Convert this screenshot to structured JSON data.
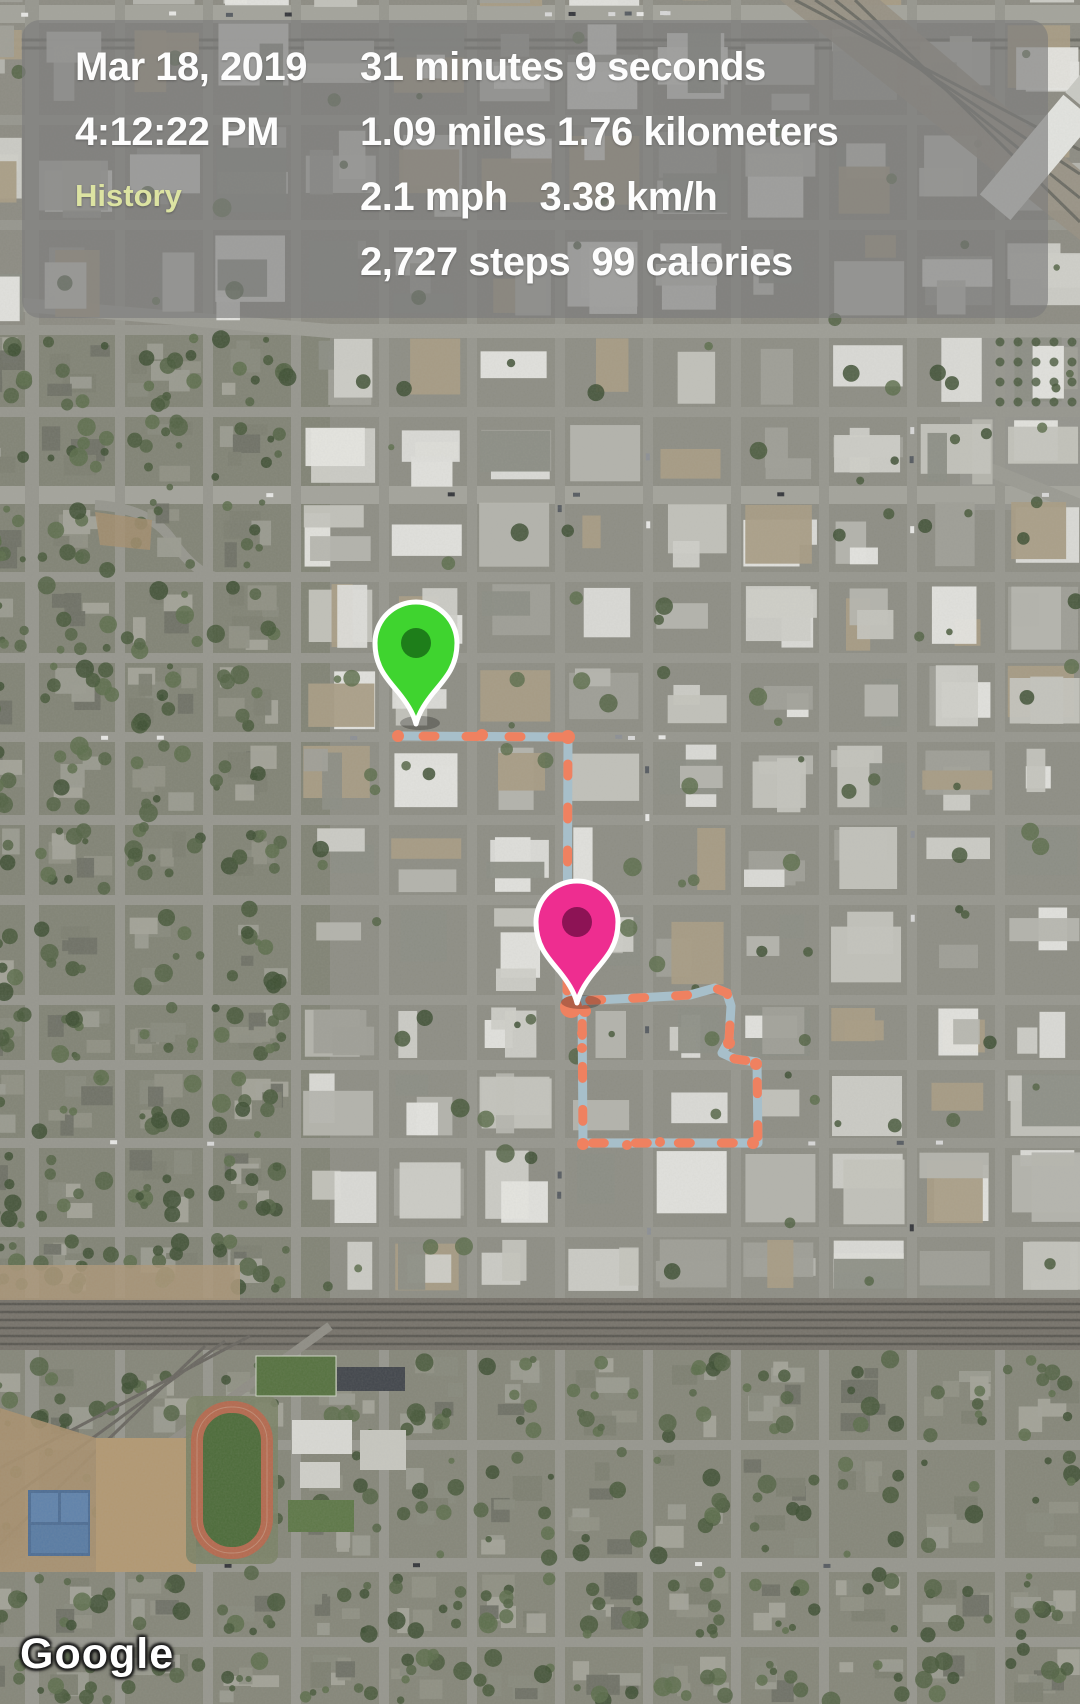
{
  "panel": {
    "date": "Mar 18, 2019",
    "time": "4:12:22 PM",
    "screen_label": "History",
    "stats": [
      "31 minutes 9 seconds",
      "1.09 miles 1.76 kilometers",
      "2.1 mph   3.38 km/h",
      "2,727 steps  99 calories"
    ]
  },
  "map": {
    "type": "satellite",
    "attribution": "Google",
    "markers": [
      {
        "id": "start-marker",
        "pin_color": "#3fd42f",
        "inner_color": "#1e7e1a",
        "x": 416,
        "y": 724
      },
      {
        "id": "end-marker",
        "pin_color": "#ee2d90",
        "inner_color": "#8d1355",
        "x": 577,
        "y": 1003
      }
    ],
    "route": {
      "line_color": "#a7bfca",
      "dash_color": "#ef8160",
      "points": [
        [
          398,
          736
        ],
        [
          568,
          737
        ],
        [
          567,
          999
        ],
        [
          575,
          1001
        ],
        [
          637,
          998
        ],
        [
          690,
          995
        ],
        [
          715,
          988
        ],
        [
          727,
          993
        ],
        [
          731,
          1006
        ],
        [
          729,
          1040
        ],
        [
          722,
          1053
        ],
        [
          735,
          1059
        ],
        [
          757,
          1062
        ],
        [
          758,
          1143
        ],
        [
          583,
          1143
        ],
        [
          582,
          1001
        ]
      ],
      "dots": [
        [
          398,
          736,
          6
        ],
        [
          482,
          735,
          6
        ],
        [
          568,
          737,
          7
        ],
        [
          571,
          1007,
          11
        ],
        [
          585,
          1011,
          6
        ],
        [
          729,
          1043,
          6
        ],
        [
          756,
          1064,
          6
        ],
        [
          583,
          1144,
          6
        ],
        [
          627,
          1145,
          5
        ],
        [
          660,
          1142,
          5
        ],
        [
          753,
          1143,
          6
        ],
        [
          582,
          1033,
          5
        ],
        [
          582,
          1048,
          5
        ]
      ]
    }
  }
}
